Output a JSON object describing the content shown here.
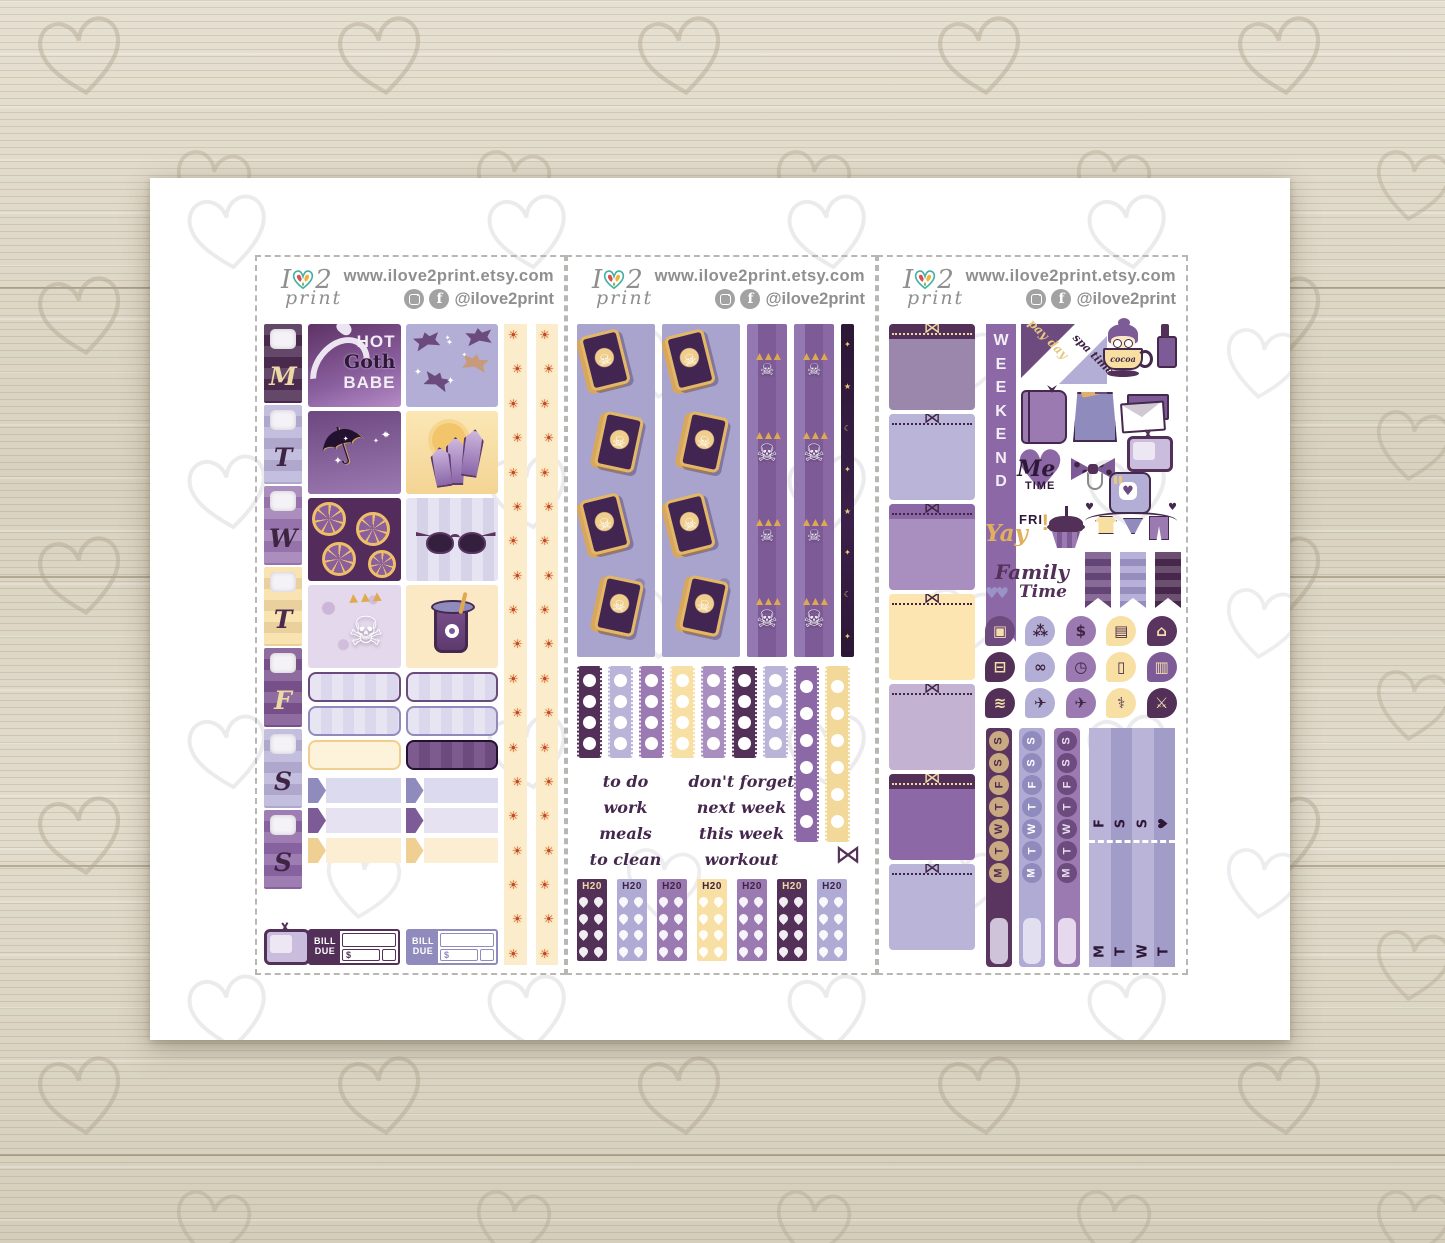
{
  "header": {
    "logo_i": "I",
    "logo_2": "2",
    "logo_script": "print",
    "website": "www.ilove2print.etsy.com",
    "handle": "@ilove2print",
    "facebook_glyph": "f",
    "social_icons": [
      "instagram-icon",
      "facebook-icon"
    ]
  },
  "glyphs": {
    "sun": "☀",
    "umbrella": "☂",
    "skull": "☠",
    "sparkle": "✦",
    "star": "★",
    "moon": "☾",
    "heart": "♥",
    "bow": "⋈",
    "leaves": "▲▲▲"
  },
  "sheet1": {
    "days": [
      {
        "letter": "M",
        "bg": "#4b2a50",
        "fg": "#ecd9a4"
      },
      {
        "letter": "T",
        "bg": "#b9b4d8",
        "fg": "#3f2544"
      },
      {
        "letter": "W",
        "bg": "#9d7ab3",
        "fg": "#3f2544"
      },
      {
        "letter": "T",
        "bg": "#f8dfa4",
        "fg": "#4b2a50"
      },
      {
        "letter": "F",
        "bg": "#7c5490",
        "fg": "#ecd9a4"
      },
      {
        "letter": "S",
        "bg": "#b9b4d8",
        "fg": "#3f2544"
      },
      {
        "letter": "S",
        "bg": "#8d68a6",
        "fg": "#3f2544"
      }
    ],
    "goth_box": {
      "line1": "HOT",
      "line2": "Goth",
      "line3": "BABE"
    },
    "art_boxes": [
      "hot-goth-babe",
      "bats-pattern",
      "celestial-umbrella",
      "crystals-sun",
      "citrus-pattern",
      "bat-sunglasses",
      "skull-planter",
      "eyeball-drink"
    ],
    "washi_sun_count": 19,
    "flags": [
      {
        "tip": "#8f8bbd",
        "body": "#dcdaee"
      },
      {
        "tip": "#8f8bbd",
        "body": "#dcdaee"
      },
      {
        "tip": "#7d5b96",
        "body": "#e6e2f2"
      },
      {
        "tip": "#7d5b96",
        "body": "#e6e2f2"
      },
      {
        "tip": "#efcf92",
        "body": "#fbeed2"
      },
      {
        "tip": "#efcf92",
        "body": "#fbeed2"
      }
    ],
    "bill_stickers": [
      {
        "line1": "BILL",
        "line2": "DUE",
        "currency": "$",
        "color": "#533058"
      },
      {
        "line1": "BILL",
        "line2": "DUE",
        "currency": "$",
        "color": "#8f8bbd"
      }
    ]
  },
  "sheet2": {
    "tarot_cards_per_strip": 4,
    "skull_items_per_strip": 4,
    "checklists": [
      {
        "color": "#533058",
        "tall": false
      },
      {
        "color": "#b9b4d8",
        "tall": false
      },
      {
        "color": "#9b79b1",
        "tall": false
      },
      {
        "color": "#f8dfa4",
        "tall": false
      },
      {
        "color": "#a88fc0",
        "tall": false
      },
      {
        "color": "#533058",
        "tall": false
      },
      {
        "color": "#b9b4d8",
        "tall": false
      },
      {
        "color": "#8d68a6",
        "tall": true
      },
      {
        "color": "#f3d999",
        "tall": true
      }
    ],
    "phrases_left": [
      "to do",
      "work",
      "meals",
      "to clean"
    ],
    "phrases_right": [
      "don't forget",
      "next week",
      "this week",
      "workout"
    ],
    "h2o": [
      {
        "label": "H20",
        "bg": "#533058",
        "fg": "#ecd9a4"
      },
      {
        "label": "H20",
        "bg": "#b0abd4",
        "fg": "#3f2544"
      },
      {
        "label": "H20",
        "bg": "#9b79b1",
        "fg": "#3f2544"
      },
      {
        "label": "H20",
        "bg": "#f8dfa4",
        "fg": "#3f2544"
      },
      {
        "label": "H20",
        "bg": "#9b79b1",
        "fg": "#3f2544"
      },
      {
        "label": "H20",
        "bg": "#533058",
        "fg": "#ecd9a4"
      },
      {
        "label": "H20",
        "bg": "#b0abd4",
        "fg": "#3f2544"
      }
    ]
  },
  "sheet3": {
    "weekend": "WEEKEND",
    "corner_payday": "pay day",
    "corner_spa": "spa time",
    "cup_text": "cocoa",
    "me_line1": "Me",
    "me_line2": "TIME",
    "fri": "FRI",
    "yay": "Yay",
    "excl": "!",
    "family_line1": "Family",
    "family_line2": "Time",
    "boxes": [
      {
        "body": "#9b87ab",
        "band": "#533058",
        "bow": "#ecd9a4"
      },
      {
        "body": "#b9b4d8",
        "band": "#b9b4d8",
        "bow": "#3f2544"
      },
      {
        "body": "#a98fc0",
        "band": "#8d68a6",
        "bow": "#3f2544"
      },
      {
        "body": "#fce5b0",
        "band": "#fce5b0",
        "bow": "#3f2544"
      },
      {
        "body": "#c3b2d2",
        "band": "#c3b2d2",
        "bow": "#3f2544"
      },
      {
        "body": "#8d68a6",
        "band": "#533058",
        "bow": "#ecd9a4"
      },
      {
        "body": "#b9b4d8",
        "band": "#b9b4d8",
        "bow": "#3f2544"
      }
    ],
    "pennants": [
      "#6d4b7f",
      "#a79fd0",
      "#4b2a50"
    ],
    "icons": [
      {
        "name": "gift-icon",
        "glyph": "▣",
        "bg": "#6d4b7f",
        "fg": "#f3dfae"
      },
      {
        "name": "paw-icon",
        "glyph": "⁂",
        "bg": "#b3aed6",
        "fg": "#3f2544"
      },
      {
        "name": "dollar-icon",
        "glyph": "$",
        "bg": "#9b79b1",
        "fg": "#3f2544"
      },
      {
        "name": "credit-card-icon",
        "glyph": "▤",
        "bg": "#f8dfa4",
        "fg": "#4b2a50"
      },
      {
        "name": "house-icon",
        "glyph": "⌂",
        "bg": "#5a3560",
        "fg": "#f3dfae"
      },
      {
        "name": "car-icon",
        "glyph": "⊟",
        "bg": "#533058",
        "fg": "#f3dfae"
      },
      {
        "name": "dumbbell-icon",
        "glyph": "∞",
        "bg": "#b3aed6",
        "fg": "#3f2544"
      },
      {
        "name": "alarm-clock-icon",
        "glyph": "◷",
        "bg": "#9b79b1",
        "fg": "#3f2544"
      },
      {
        "name": "trash-icon",
        "glyph": "▯",
        "bg": "#f8dfa4",
        "fg": "#4b2a50"
      },
      {
        "name": "gas-pump-icon",
        "glyph": "▥",
        "bg": "#7d5b96",
        "fg": "#f3dfae"
      },
      {
        "name": "spray-bottle-icon",
        "glyph": "≋",
        "bg": "#533058",
        "fg": "#f3dfae"
      },
      {
        "name": "airplane-icon",
        "glyph": "✈",
        "bg": "#b3aed6",
        "fg": "#3f2544"
      },
      {
        "name": "airplane-2-icon",
        "glyph": "✈",
        "bg": "#9b79b1",
        "fg": "#3f2544"
      },
      {
        "name": "stethoscope-icon",
        "glyph": "⚕",
        "bg": "#f8dfa4",
        "fg": "#4b2a50"
      },
      {
        "name": "utensils-icon",
        "glyph": "⚔",
        "bg": "#533058",
        "fg": "#f3dfae"
      }
    ],
    "day_strips": [
      {
        "bg": "#5a3560",
        "circle": "#c9a981",
        "fg": "#4b2a50",
        "blank": "#cfc3da",
        "letters": [
          "S",
          "S",
          "F",
          "T",
          "W",
          "T",
          "M"
        ]
      },
      {
        "bg": "#b0abd4",
        "circle": "#8f8bbd",
        "fg": "#ffffff",
        "blank": "#e2dff0",
        "letters": [
          "S",
          "S",
          "F",
          "T",
          "W",
          "T",
          "M"
        ]
      },
      {
        "bg": "#9b79b1",
        "circle": "#6d4b7f",
        "fg": "#e8dff0",
        "blank": "#e6d9ee",
        "letters": [
          "S",
          "S",
          "F",
          "T",
          "W",
          "T",
          "M"
        ]
      }
    ],
    "week_block": {
      "top": [
        "F",
        "S",
        "S",
        "♥"
      ],
      "bottom": [
        "M",
        "T",
        "W",
        "T"
      ],
      "cols": [
        "#b9b4d8",
        "#a29cc9",
        "#b9b4d8",
        "#a29cc9"
      ]
    }
  }
}
